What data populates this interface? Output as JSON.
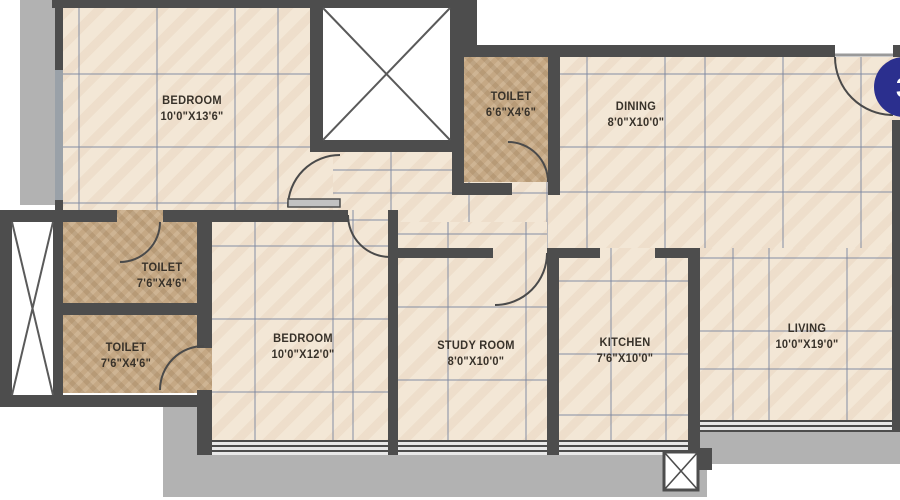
{
  "floorplan": {
    "rooms": [
      {
        "name": "BEDROOM",
        "dims": "10'0\"X13'6\""
      },
      {
        "name": "TOILET",
        "dims": "6'6\"X4'6\""
      },
      {
        "name": "DINING",
        "dims": "8'0\"X10'0\""
      },
      {
        "name": "TOILET",
        "dims": "7'6\"X4'6\""
      },
      {
        "name": "TOILET",
        "dims": "7'6\"X4'6\""
      },
      {
        "name": "BEDROOM",
        "dims": "10'0\"X12'0\""
      },
      {
        "name": "STUDY ROOM",
        "dims": "8'0\"X10'0\""
      },
      {
        "name": "KITCHEN",
        "dims": "7'6\"X10'0\""
      },
      {
        "name": "LIVING",
        "dims": "10'0\"X19'0\""
      }
    ],
    "entry_marker": {
      "label": "3",
      "color": "#2b2f8e"
    },
    "colors": {
      "wall": "#4d4d4d",
      "floor_tile": "#f3e7d6",
      "toilet_tile": "#c5a884",
      "balcony": "#b2b2b2",
      "grid_line": "#7884a0",
      "label_text": "#38322a",
      "entry_circle": "#2b2f8e"
    }
  }
}
